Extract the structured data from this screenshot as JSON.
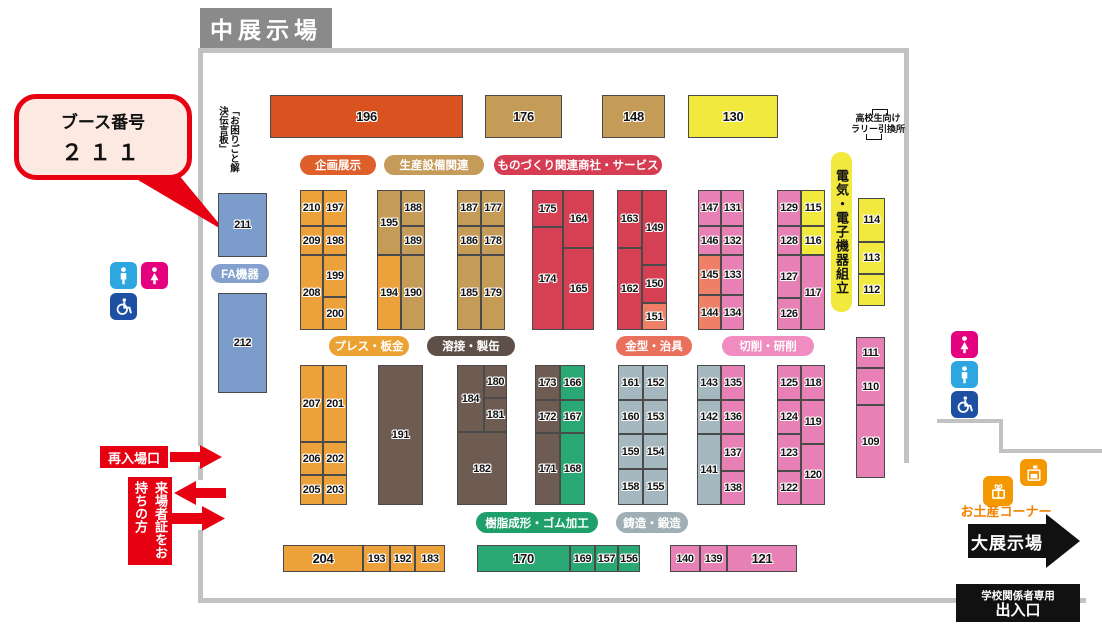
{
  "title": "中展示場",
  "callout": {
    "line1": "ブース番号",
    "line2": "２１１"
  },
  "annotations": {
    "notice_board": "「お困りごと解決伝言板」",
    "highschool_line1": "高校生向け",
    "highschool_line2": "ラリー引換所",
    "reentry": "再入場口",
    "visitor_pass": "来場者証をお持ちの方",
    "souvenir": "お土産コーナー",
    "big_hall": "大展示場",
    "school_gate_line1": "学校関係者専用",
    "school_gate_line2": "出入口"
  },
  "palette": {
    "darkorange": "#D8531F",
    "orange": "#EDA13B",
    "tan": "#C59B58",
    "red": "#D64055",
    "salmon": "#ED8066",
    "pink": "#E780B4",
    "yellow": "#F2E93E",
    "blue": "#7C9CCB",
    "brown": "#6E5C52",
    "green": "#29A873",
    "grayblue": "#A5B8BF",
    "accent_red": "#E60012",
    "black": "#111111",
    "wall_gray": "#C2C2C2",
    "title_gray": "#8A8A8A",
    "souvenir_orange": "#F39800"
  },
  "categories": [
    {
      "name": "kikaku-tenji",
      "label": "企画展示",
      "x": 300,
      "y": 155,
      "w": 76,
      "h": 20,
      "bg": "#DE5F2A",
      "fg": "#ffffff"
    },
    {
      "name": "seisan-setsubi",
      "label": "生産設備関連",
      "x": 384,
      "y": 155,
      "w": 100,
      "h": 20,
      "bg": "#C49B59",
      "fg": "#ffffff"
    },
    {
      "name": "monodukuri-shosha",
      "label": "ものづくり関連商社・サービス",
      "x": 494,
      "y": 155,
      "w": 168,
      "h": 20,
      "bg": "#D63D52",
      "fg": "#ffffff"
    },
    {
      "name": "denki-denshi-kumitate",
      "label": "電気・電子機器組立",
      "x": 831,
      "y": 152,
      "w": 21,
      "h": 160,
      "bg": "#F2E93E",
      "fg": "#111111",
      "vertical": true
    },
    {
      "name": "press-bankin",
      "label": "プレス・板金",
      "x": 329,
      "y": 336,
      "w": 80,
      "h": 20,
      "bg": "#EBA233",
      "fg": "#ffffff"
    },
    {
      "name": "yosetsu-seikan",
      "label": "溶接・製缶",
      "x": 427,
      "y": 336,
      "w": 88,
      "h": 20,
      "bg": "#5E4F48",
      "fg": "#ffffff"
    },
    {
      "name": "kanagata-jigu",
      "label": "金型・治具",
      "x": 616,
      "y": 336,
      "w": 76,
      "h": 20,
      "bg": "#E8705C",
      "fg": "#ffffff"
    },
    {
      "name": "sessaku-kensaku",
      "label": "切削・研削",
      "x": 722,
      "y": 336,
      "w": 92,
      "h": 20,
      "bg": "#F08CC0",
      "fg": "#ffffff"
    },
    {
      "name": "jushi-gomu",
      "label": "樹脂成形・ゴム加工",
      "x": 476,
      "y": 512,
      "w": 122,
      "h": 21,
      "bg": "#1FA06A",
      "fg": "#ffffff"
    },
    {
      "name": "chuzo-tanzo",
      "label": "鋳造・鍛造",
      "x": 616,
      "y": 512,
      "w": 72,
      "h": 21,
      "bg": "#9FAFB5",
      "fg": "#ffffff"
    },
    {
      "name": "fa-kiki",
      "label": "FA機器",
      "x": 211,
      "y": 264,
      "w": 58,
      "h": 19,
      "bg": "#84A1CE",
      "fg": "#ffffff"
    }
  ],
  "icons": [
    {
      "name": "male-toilet-icon-left",
      "type": "male",
      "x": 110,
      "y": 262,
      "s": 27,
      "bg": "#2EA7E0"
    },
    {
      "name": "female-toilet-icon-left",
      "type": "female",
      "x": 141,
      "y": 262,
      "s": 27,
      "bg": "#E4007F"
    },
    {
      "name": "wheelchair-icon-left",
      "type": "wheelchair",
      "x": 110,
      "y": 293,
      "s": 27,
      "bg": "#1D50A2"
    },
    {
      "name": "female-toilet-icon-right",
      "type": "female",
      "x": 951,
      "y": 331,
      "s": 27,
      "bg": "#E4007F"
    },
    {
      "name": "male-toilet-icon-right",
      "type": "male",
      "x": 951,
      "y": 361,
      "s": 27,
      "bg": "#2EA7E0"
    },
    {
      "name": "wheelchair-icon-right",
      "type": "wheelchair",
      "x": 951,
      "y": 391,
      "s": 27,
      "bg": "#1D50A2"
    },
    {
      "name": "gift-icon",
      "type": "gift",
      "x": 983,
      "y": 476,
      "s": 30,
      "bg": "#F39800"
    },
    {
      "name": "shop-icon",
      "type": "shop",
      "x": 1020,
      "y": 459,
      "s": 27,
      "bg": "#F39800"
    }
  ],
  "booths": [
    {
      "n": 196,
      "x": 270,
      "y": 95,
      "w": 193,
      "h": 43,
      "c": "darkorange"
    },
    {
      "n": 176,
      "x": 485,
      "y": 95,
      "w": 77,
      "h": 43,
      "c": "tan"
    },
    {
      "n": 148,
      "x": 602,
      "y": 95,
      "w": 63,
      "h": 43,
      "c": "tan"
    },
    {
      "n": 130,
      "x": 688,
      "y": 95,
      "w": 90,
      "h": 43,
      "c": "yellow"
    },
    {
      "n": 211,
      "x": 218,
      "y": 193,
      "w": 49,
      "h": 64,
      "c": "blue"
    },
    {
      "n": 212,
      "x": 218,
      "y": 293,
      "w": 49,
      "h": 100,
      "c": "blue"
    },
    {
      "n": 210,
      "x": 300,
      "y": 190,
      "w": 23,
      "h": 36,
      "c": "orange"
    },
    {
      "n": 197,
      "x": 323,
      "y": 190,
      "w": 24,
      "h": 36,
      "c": "orange"
    },
    {
      "n": 209,
      "x": 300,
      "y": 226,
      "w": 23,
      "h": 29,
      "c": "orange"
    },
    {
      "n": 198,
      "x": 323,
      "y": 226,
      "w": 24,
      "h": 29,
      "c": "orange"
    },
    {
      "n": 208,
      "x": 300,
      "y": 255,
      "w": 23,
      "h": 75,
      "c": "orange"
    },
    {
      "n": 199,
      "x": 323,
      "y": 255,
      "w": 24,
      "h": 42,
      "c": "orange"
    },
    {
      "n": 200,
      "x": 323,
      "y": 297,
      "w": 24,
      "h": 33,
      "c": "orange"
    },
    {
      "n": 195,
      "x": 377,
      "y": 190,
      "w": 24,
      "h": 65,
      "c": "tan"
    },
    {
      "n": 188,
      "x": 401,
      "y": 190,
      "w": 24,
      "h": 36,
      "c": "tan"
    },
    {
      "n": 189,
      "x": 401,
      "y": 226,
      "w": 24,
      "h": 29,
      "c": "tan"
    },
    {
      "n": 194,
      "x": 377,
      "y": 255,
      "w": 24,
      "h": 75,
      "c": "orange"
    },
    {
      "n": 190,
      "x": 401,
      "y": 255,
      "w": 24,
      "h": 75,
      "c": "tan"
    },
    {
      "n": 187,
      "x": 457,
      "y": 190,
      "w": 24,
      "h": 36,
      "c": "tan"
    },
    {
      "n": 177,
      "x": 481,
      "y": 190,
      "w": 24,
      "h": 36,
      "c": "tan"
    },
    {
      "n": 186,
      "x": 457,
      "y": 226,
      "w": 24,
      "h": 29,
      "c": "tan"
    },
    {
      "n": 178,
      "x": 481,
      "y": 226,
      "w": 24,
      "h": 29,
      "c": "tan"
    },
    {
      "n": 185,
      "x": 457,
      "y": 255,
      "w": 24,
      "h": 75,
      "c": "tan"
    },
    {
      "n": 179,
      "x": 481,
      "y": 255,
      "w": 24,
      "h": 75,
      "c": "tan"
    },
    {
      "n": 175,
      "x": 532,
      "y": 190,
      "w": 31,
      "h": 37,
      "c": "red"
    },
    {
      "n": 164,
      "x": 563,
      "y": 190,
      "w": 31,
      "h": 58,
      "c": "red"
    },
    {
      "n": 174,
      "x": 532,
      "y": 227,
      "w": 31,
      "h": 103,
      "c": "red"
    },
    {
      "n": 165,
      "x": 563,
      "y": 248,
      "w": 31,
      "h": 82,
      "c": "red"
    },
    {
      "n": 163,
      "x": 617,
      "y": 190,
      "w": 25,
      "h": 58,
      "c": "red"
    },
    {
      "n": 149,
      "x": 642,
      "y": 190,
      "w": 25,
      "h": 75,
      "c": "red"
    },
    {
      "n": 162,
      "x": 617,
      "y": 248,
      "w": 25,
      "h": 82,
      "c": "red"
    },
    {
      "n": 150,
      "x": 642,
      "y": 265,
      "w": 25,
      "h": 38,
      "c": "red"
    },
    {
      "n": 151,
      "x": 642,
      "y": 303,
      "w": 25,
      "h": 27,
      "c": "salmon"
    },
    {
      "n": 147,
      "x": 698,
      "y": 190,
      "w": 23,
      "h": 36,
      "c": "pink"
    },
    {
      "n": 131,
      "x": 721,
      "y": 190,
      "w": 23,
      "h": 36,
      "c": "pink"
    },
    {
      "n": 146,
      "x": 698,
      "y": 226,
      "w": 23,
      "h": 29,
      "c": "pink"
    },
    {
      "n": 132,
      "x": 721,
      "y": 226,
      "w": 23,
      "h": 29,
      "c": "pink"
    },
    {
      "n": 145,
      "x": 698,
      "y": 255,
      "w": 23,
      "h": 40,
      "c": "salmon"
    },
    {
      "n": 133,
      "x": 721,
      "y": 255,
      "w": 23,
      "h": 40,
      "c": "pink"
    },
    {
      "n": 144,
      "x": 698,
      "y": 295,
      "w": 23,
      "h": 35,
      "c": "salmon"
    },
    {
      "n": 134,
      "x": 721,
      "y": 295,
      "w": 23,
      "h": 35,
      "c": "pink"
    },
    {
      "n": 129,
      "x": 777,
      "y": 190,
      "w": 24,
      "h": 36,
      "c": "pink"
    },
    {
      "n": 115,
      "x": 801,
      "y": 190,
      "w": 24,
      "h": 36,
      "c": "yellow"
    },
    {
      "n": 128,
      "x": 777,
      "y": 226,
      "w": 24,
      "h": 29,
      "c": "pink"
    },
    {
      "n": 116,
      "x": 801,
      "y": 226,
      "w": 24,
      "h": 29,
      "c": "yellow"
    },
    {
      "n": 127,
      "x": 777,
      "y": 255,
      "w": 24,
      "h": 43,
      "c": "pink"
    },
    {
      "n": 117,
      "x": 801,
      "y": 255,
      "w": 24,
      "h": 75,
      "c": "pink"
    },
    {
      "n": 126,
      "x": 777,
      "y": 298,
      "w": 24,
      "h": 32,
      "c": "pink"
    },
    {
      "n": 114,
      "x": 858,
      "y": 198,
      "w": 27,
      "h": 44,
      "c": "yellow"
    },
    {
      "n": 113,
      "x": 858,
      "y": 242,
      "w": 27,
      "h": 32,
      "c": "yellow"
    },
    {
      "n": 112,
      "x": 858,
      "y": 274,
      "w": 27,
      "h": 32,
      "c": "yellow"
    },
    {
      "n": 207,
      "x": 300,
      "y": 365,
      "w": 23,
      "h": 77,
      "c": "orange"
    },
    {
      "n": 201,
      "x": 323,
      "y": 365,
      "w": 24,
      "h": 77,
      "c": "orange"
    },
    {
      "n": 206,
      "x": 300,
      "y": 442,
      "w": 23,
      "h": 33,
      "c": "orange"
    },
    {
      "n": 202,
      "x": 323,
      "y": 442,
      "w": 24,
      "h": 33,
      "c": "orange"
    },
    {
      "n": 205,
      "x": 300,
      "y": 475,
      "w": 23,
      "h": 30,
      "c": "orange"
    },
    {
      "n": 203,
      "x": 323,
      "y": 475,
      "w": 24,
      "h": 30,
      "c": "orange"
    },
    {
      "n": 191,
      "x": 378,
      "y": 365,
      "w": 45,
      "h": 140,
      "c": "brown"
    },
    {
      "n": 184,
      "x": 457,
      "y": 365,
      "w": 27,
      "h": 67,
      "c": "brown"
    },
    {
      "n": 180,
      "x": 484,
      "y": 365,
      "w": 23,
      "h": 33,
      "c": "brown"
    },
    {
      "n": 181,
      "x": 484,
      "y": 398,
      "w": 23,
      "h": 34,
      "c": "brown"
    },
    {
      "n": 182,
      "x": 457,
      "y": 432,
      "w": 50,
      "h": 73,
      "c": "brown"
    },
    {
      "n": 173,
      "x": 535,
      "y": 365,
      "w": 25,
      "h": 35,
      "c": "brown"
    },
    {
      "n": 166,
      "x": 560,
      "y": 365,
      "w": 25,
      "h": 35,
      "c": "green"
    },
    {
      "n": 172,
      "x": 535,
      "y": 400,
      "w": 25,
      "h": 33,
      "c": "brown"
    },
    {
      "n": 167,
      "x": 560,
      "y": 400,
      "w": 25,
      "h": 33,
      "c": "green"
    },
    {
      "n": 171,
      "x": 535,
      "y": 433,
      "w": 25,
      "h": 72,
      "c": "brown"
    },
    {
      "n": 168,
      "x": 560,
      "y": 433,
      "w": 25,
      "h": 72,
      "c": "green"
    },
    {
      "n": 161,
      "x": 618,
      "y": 365,
      "w": 25,
      "h": 35,
      "c": "grayblue"
    },
    {
      "n": 152,
      "x": 643,
      "y": 365,
      "w": 25,
      "h": 35,
      "c": "grayblue"
    },
    {
      "n": 160,
      "x": 618,
      "y": 400,
      "w": 25,
      "h": 34,
      "c": "grayblue"
    },
    {
      "n": 153,
      "x": 643,
      "y": 400,
      "w": 25,
      "h": 34,
      "c": "grayblue"
    },
    {
      "n": 159,
      "x": 618,
      "y": 434,
      "w": 25,
      "h": 35,
      "c": "grayblue"
    },
    {
      "n": 154,
      "x": 643,
      "y": 434,
      "w": 25,
      "h": 35,
      "c": "grayblue"
    },
    {
      "n": 158,
      "x": 618,
      "y": 469,
      "w": 25,
      "h": 36,
      "c": "grayblue"
    },
    {
      "n": 155,
      "x": 643,
      "y": 469,
      "w": 25,
      "h": 36,
      "c": "grayblue"
    },
    {
      "n": 143,
      "x": 697,
      "y": 365,
      "w": 24,
      "h": 35,
      "c": "grayblue"
    },
    {
      "n": 135,
      "x": 721,
      "y": 365,
      "w": 24,
      "h": 35,
      "c": "pink"
    },
    {
      "n": 142,
      "x": 697,
      "y": 400,
      "w": 24,
      "h": 34,
      "c": "grayblue"
    },
    {
      "n": 136,
      "x": 721,
      "y": 400,
      "w": 24,
      "h": 34,
      "c": "pink"
    },
    {
      "n": 141,
      "x": 697,
      "y": 434,
      "w": 24,
      "h": 71,
      "c": "grayblue"
    },
    {
      "n": 137,
      "x": 721,
      "y": 434,
      "w": 24,
      "h": 37,
      "c": "pink"
    },
    {
      "n": 138,
      "x": 721,
      "y": 471,
      "w": 24,
      "h": 34,
      "c": "pink"
    },
    {
      "n": 125,
      "x": 777,
      "y": 365,
      "w": 24,
      "h": 35,
      "c": "pink"
    },
    {
      "n": 118,
      "x": 801,
      "y": 365,
      "w": 24,
      "h": 35,
      "c": "pink"
    },
    {
      "n": 124,
      "x": 777,
      "y": 400,
      "w": 24,
      "h": 34,
      "c": "pink"
    },
    {
      "n": 119,
      "x": 801,
      "y": 400,
      "w": 24,
      "h": 44,
      "c": "pink"
    },
    {
      "n": 123,
      "x": 777,
      "y": 434,
      "w": 24,
      "h": 37,
      "c": "pink"
    },
    {
      "n": 120,
      "x": 801,
      "y": 444,
      "w": 24,
      "h": 61,
      "c": "pink"
    },
    {
      "n": 122,
      "x": 777,
      "y": 471,
      "w": 24,
      "h": 34,
      "c": "pink"
    },
    {
      "n": 111,
      "x": 856,
      "y": 337,
      "w": 29,
      "h": 31,
      "c": "pink"
    },
    {
      "n": 110,
      "x": 856,
      "y": 368,
      "w": 29,
      "h": 37,
      "c": "pink"
    },
    {
      "n": 109,
      "x": 856,
      "y": 405,
      "w": 29,
      "h": 73,
      "c": "pink"
    },
    {
      "n": 204,
      "x": 283,
      "y": 545,
      "w": 80,
      "h": 27,
      "c": "orange"
    },
    {
      "n": 193,
      "x": 363,
      "y": 545,
      "w": 27,
      "h": 27,
      "c": "orange"
    },
    {
      "n": 192,
      "x": 390,
      "y": 545,
      "w": 25,
      "h": 27,
      "c": "orange"
    },
    {
      "n": 183,
      "x": 415,
      "y": 545,
      "w": 30,
      "h": 27,
      "c": "orange"
    },
    {
      "n": 170,
      "x": 477,
      "y": 545,
      "w": 93,
      "h": 27,
      "c": "green"
    },
    {
      "n": 169,
      "x": 570,
      "y": 545,
      "w": 25,
      "h": 27,
      "c": "green"
    },
    {
      "n": 157,
      "x": 595,
      "y": 545,
      "w": 23,
      "h": 27,
      "c": "green"
    },
    {
      "n": 156,
      "x": 618,
      "y": 545,
      "w": 22,
      "h": 27,
      "c": "green"
    },
    {
      "n": 140,
      "x": 670,
      "y": 545,
      "w": 30,
      "h": 27,
      "c": "pink"
    },
    {
      "n": 139,
      "x": 700,
      "y": 545,
      "w": 27,
      "h": 27,
      "c": "pink"
    },
    {
      "n": 121,
      "x": 727,
      "y": 545,
      "w": 70,
      "h": 27,
      "c": "pink"
    }
  ]
}
